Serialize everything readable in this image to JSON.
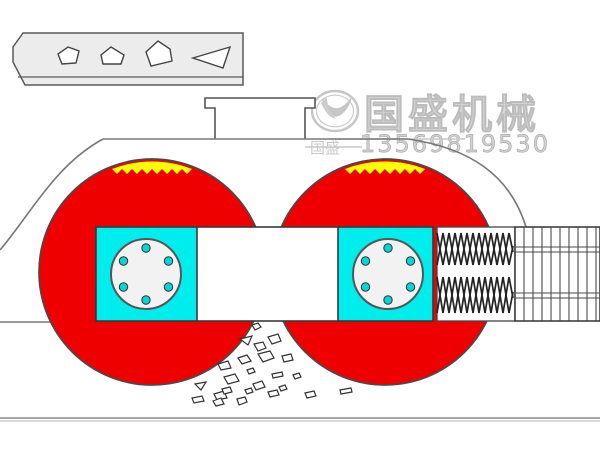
{
  "watermark": {
    "brand": "国盛机械",
    "brand_small": "国盛",
    "phone": "13569819530"
  },
  "colors": {
    "roller_red": "#ee0000",
    "bearing_cyan": "#00eded",
    "teeth_yellow": "#ffff00",
    "bolt_cyan": "#00d8d8",
    "chute_gray": "#ececec",
    "watermark_gray": "#c9c9c9",
    "line_dark": "#3c3c3c",
    "line_housing": "#777777"
  }
}
